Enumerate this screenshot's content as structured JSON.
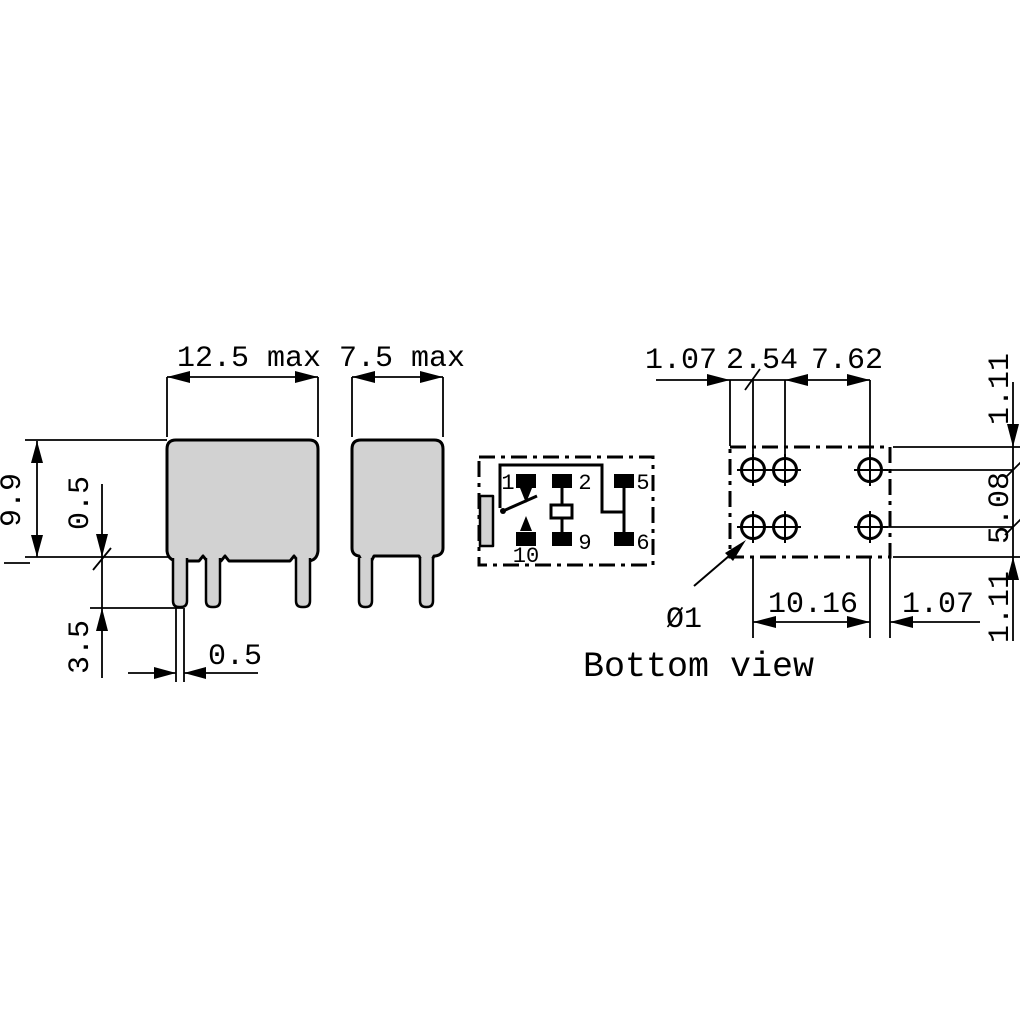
{
  "front_view": {
    "width_max": "12.5 max",
    "body_height": "9.9",
    "standoff_height": "0.5",
    "pin_length": "3.5",
    "pin_thickness": "0.5"
  },
  "side_view": {
    "depth_max": "7.5 max"
  },
  "schematic": {
    "pin1": "1",
    "pin2": "2",
    "pin5": "5",
    "pin10": "10",
    "pin9": "9",
    "pin6": "6"
  },
  "bottom_view": {
    "caption": "Bottom view",
    "hole_diameter": "Ø1",
    "dim_left_offset": "1.07",
    "dim_coil_pitch": "2.54",
    "dim_contact_pitch": "7.62",
    "dim_top_offset": "1.11",
    "dim_row_spacing": "5.08",
    "dim_bottom_offset": "1.11",
    "dim_column_span": "10.16",
    "dim_right_offset": "1.07"
  },
  "colors": {
    "line": "#000000",
    "body_fill": "#d2d2d2",
    "background": "#ffffff"
  }
}
